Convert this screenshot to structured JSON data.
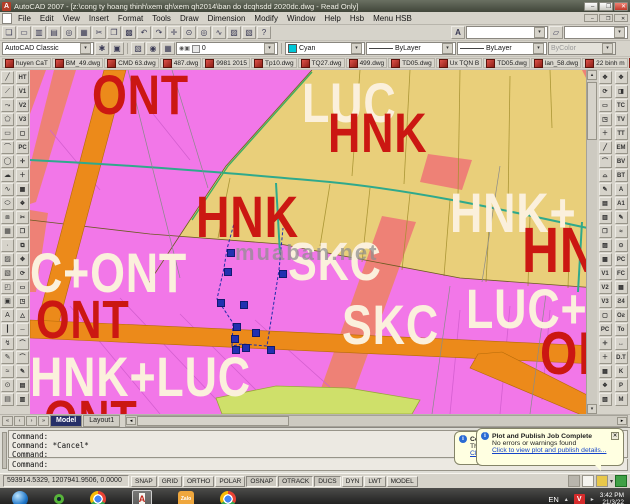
{
  "window": {
    "title": "AutoCAD 2007 - [z:\\cong ty hoang thinh\\xem qh\\xem qh2014\\ban do dcqhsdd 2020dc.dwg - Read Only]",
    "min": "–",
    "max": "❐",
    "close": "✕",
    "mdi_min": "–",
    "mdi_restore": "❐",
    "mdi_close": "✕"
  },
  "menu": {
    "items": [
      "File",
      "Edit",
      "View",
      "Insert",
      "Format",
      "Tools",
      "Draw",
      "Dimension",
      "Modify",
      "Window",
      "Help",
      "Hsb",
      "Menu HSB"
    ]
  },
  "toolbar": {
    "standard": [
      {
        "n": "new",
        "g": "❏"
      },
      {
        "n": "open",
        "g": "▭"
      },
      {
        "n": "save",
        "g": "▥"
      },
      {
        "n": "plot",
        "g": "▤"
      },
      {
        "n": "plot-preview",
        "g": "◎"
      },
      {
        "n": "publish",
        "g": "▦"
      },
      {
        "n": "cut",
        "g": "✂"
      },
      {
        "n": "copy",
        "g": "❐"
      },
      {
        "n": "paste",
        "g": "▩"
      },
      {
        "n": "undo",
        "g": "↶"
      },
      {
        "n": "redo",
        "g": "↷"
      },
      {
        "n": "pan",
        "g": "✛"
      },
      {
        "n": "zoom-realtime",
        "g": "⊙"
      },
      {
        "n": "zoom-window",
        "g": "◎"
      },
      {
        "n": "zoom-previous",
        "g": "∿"
      },
      {
        "n": "properties",
        "g": "▨"
      },
      {
        "n": "design-center",
        "g": "▧"
      },
      {
        "n": "help",
        "g": "?"
      }
    ],
    "text_style_icon": "A",
    "row2_icons": [
      {
        "n": "workspace-settings",
        "g": "✱"
      },
      {
        "n": "workspace-save",
        "g": "▣"
      }
    ],
    "layer_icons": [
      {
        "n": "layer-properties",
        "g": "▧"
      },
      {
        "n": "layer-states",
        "g": "◉"
      },
      {
        "n": "layer-previous",
        "g": "▦"
      }
    ],
    "layer_glyphs": "◉▣",
    "files": [
      {
        "label": "huyen CaT"
      },
      {
        "label": "BM_49.dwg"
      },
      {
        "label": "CMD 63.dwg"
      },
      {
        "label": "487.dwg"
      },
      {
        "label": "9981 2015"
      },
      {
        "label": "Tp10.dwg"
      },
      {
        "label": "TQ27.dwg"
      },
      {
        "label": "499.dwg"
      },
      {
        "label": "TD05.dwg"
      },
      {
        "label": "Ux TQN B"
      },
      {
        "label": "TD05.dwg"
      },
      {
        "label": "lan_58.dwg"
      },
      {
        "label": "22 binh m"
      },
      {
        "label": "CQN100 20",
        "cls": "active"
      }
    ],
    "row3_icons": [
      {
        "n": "match-properties",
        "g": "✎"
      },
      {
        "n": "tool-palettes",
        "g": "❖"
      }
    ],
    "left_col1": [
      "╱",
      "⟋",
      "⤳",
      "⬠",
      "▭",
      "⌒",
      "◯",
      "☁",
      "∿",
      "⬭",
      "⧈",
      "▦",
      "·",
      "▨",
      "▧",
      "◰",
      "▣",
      "A",
      "┃",
      "↯",
      "✎",
      "≈",
      "⊙",
      "▤"
    ],
    "left_col2": [
      "HT",
      "V1",
      "V2",
      "V3",
      "▢",
      "PC",
      "✛",
      "＋",
      "▦",
      "❖",
      "✂",
      "❐",
      "⧉",
      "✥",
      "⟳",
      "▭",
      "◳",
      "△",
      "─",
      "⌒",
      "⌒",
      "✎",
      "▤",
      "▥"
    ],
    "right_inner": [
      "✥",
      "⟳",
      "▭",
      "◳",
      "＋",
      "╱",
      "⌒",
      "⌓",
      "✎",
      "▤",
      "▥",
      "❐",
      "▨",
      "▩",
      "V1",
      "V2",
      "V3",
      "▢",
      "PC",
      "✛",
      "＋",
      "▦",
      "❖",
      "▧"
    ],
    "right_outer": [
      "✥",
      "◨",
      "TC",
      "TV",
      "TT",
      "EM",
      "BV",
      "BT",
      "A",
      "A1",
      "✎",
      "≈",
      "⊙",
      "PC",
      "FC",
      "▦",
      "Ƨ4",
      "Oƨ",
      "To",
      "↔",
      "D.T",
      "K",
      "P",
      "M"
    ]
  },
  "combos": {
    "workspace": "AutoCAD Classic",
    "layer": "0",
    "color": "Cyan",
    "linetype": "ByLayer",
    "lineweight": "ByLayer",
    "plotstyle": "ByColor"
  },
  "map": {
    "labels": [
      {
        "text": "ONT",
        "x": 62,
        "y": -3,
        "size": 56,
        "color": "#cb1712"
      },
      {
        "text": "LUC",
        "x": 272,
        "y": 5,
        "size": 56,
        "color": "#fbf0dc"
      },
      {
        "text": "HNK",
        "x": 298,
        "y": 35,
        "size": 56,
        "color": "#cb1712"
      },
      {
        "text": "HNK",
        "x": 166,
        "y": 119,
        "size": 58,
        "color": "#cb1712"
      },
      {
        "text": "HNK+",
        "x": 420,
        "y": 115,
        "size": 56,
        "color": "#fbf0dc"
      },
      {
        "text": "HN",
        "x": 492,
        "y": 148,
        "size": 64,
        "color": "#cb1712"
      },
      {
        "text": "C+ONT",
        "x": 0,
        "y": 175,
        "size": 56,
        "color": "#fbf0dc"
      },
      {
        "text": "SKC",
        "x": 258,
        "y": 165,
        "size": 54,
        "color": "#fbf0dc"
      },
      {
        "text": "SKC",
        "x": 312,
        "y": 227,
        "size": 56,
        "color": "#fbf0dc"
      },
      {
        "text": "ONT",
        "x": 6,
        "y": 223,
        "size": 54,
        "color": "#cb1712"
      },
      {
        "text": "LUC+",
        "x": 436,
        "y": 211,
        "size": 56,
        "color": "#fbf0dc"
      },
      {
        "text": "ON",
        "x": 510,
        "y": 254,
        "size": 60,
        "color": "#cb1712"
      },
      {
        "text": "HNK+LUC",
        "x": 0,
        "y": 279,
        "size": 56,
        "color": "#fbf0dc"
      },
      {
        "text": "ONT",
        "x": 14,
        "y": 323,
        "size": 54,
        "color": "#cb1712"
      },
      {
        "text": "muaban.net",
        "x": 205,
        "y": 172,
        "size": 22,
        "color": "#8f8f8f",
        "cls": "wm"
      }
    ],
    "grips": [
      {
        "x": 197,
        "y": 179
      },
      {
        "x": 194,
        "y": 198
      },
      {
        "x": 249,
        "y": 200
      },
      {
        "x": 187,
        "y": 229
      },
      {
        "x": 210,
        "y": 231
      },
      {
        "x": 203,
        "y": 253
      },
      {
        "x": 222,
        "y": 259
      },
      {
        "x": 201,
        "y": 265
      },
      {
        "x": 202,
        "y": 276
      },
      {
        "x": 212,
        "y": 274
      },
      {
        "x": 237,
        "y": 276
      }
    ],
    "region_colors": {
      "tan": "#e9cf7a",
      "pink": "#f277e8",
      "salmon": "#ee8176",
      "orange_road": "#ec8a1a",
      "teal_canal": "#2fa98c",
      "yellow_green": "#cfe06a",
      "grip_blue": "#2230b0"
    }
  },
  "tabs": {
    "nav": [
      "«",
      "‹",
      "›",
      "»"
    ],
    "model": "Model",
    "layout": "Layout1"
  },
  "command": {
    "history": [
      "Command:",
      "Command: *Cancel*",
      "Command:"
    ],
    "prompt": "Command:"
  },
  "status": {
    "coords": "593914.5329, 1207941.9506, 0.0000",
    "buttons": [
      {
        "label": "SNAP"
      },
      {
        "label": "GRID"
      },
      {
        "label": "ORTHO"
      },
      {
        "label": "POLAR"
      },
      {
        "label": "OSNAP",
        "cls": "pressed"
      },
      {
        "label": "OTRACK",
        "cls": "pressed"
      },
      {
        "label": "DUCS",
        "cls": "pressed"
      },
      {
        "label": "DYN"
      },
      {
        "label": "LWT"
      },
      {
        "label": "MODEL"
      }
    ]
  },
  "balloon_front": {
    "title": "Plot and Publish Job Complete",
    "body": "No errors or warnings found",
    "link": "Click to view plot and publish details...",
    "close": "✕",
    "info": "i"
  },
  "balloon_back": {
    "title": "Comm",
    "body": "The easy w",
    "link": "Click here.",
    "info": "i"
  },
  "taskbar": {
    "lang": "EN",
    "zalo": "Zalo",
    "vbadge": "V",
    "time": "3:42 PM",
    "date": "21/3/22"
  },
  "icons": {
    "caret": "▾",
    "vup": "▴",
    "vdown": "▾",
    "hleft": "◂",
    "hright": "▸",
    "tray_arrow": "▸",
    "lang_caret": "▴"
  }
}
